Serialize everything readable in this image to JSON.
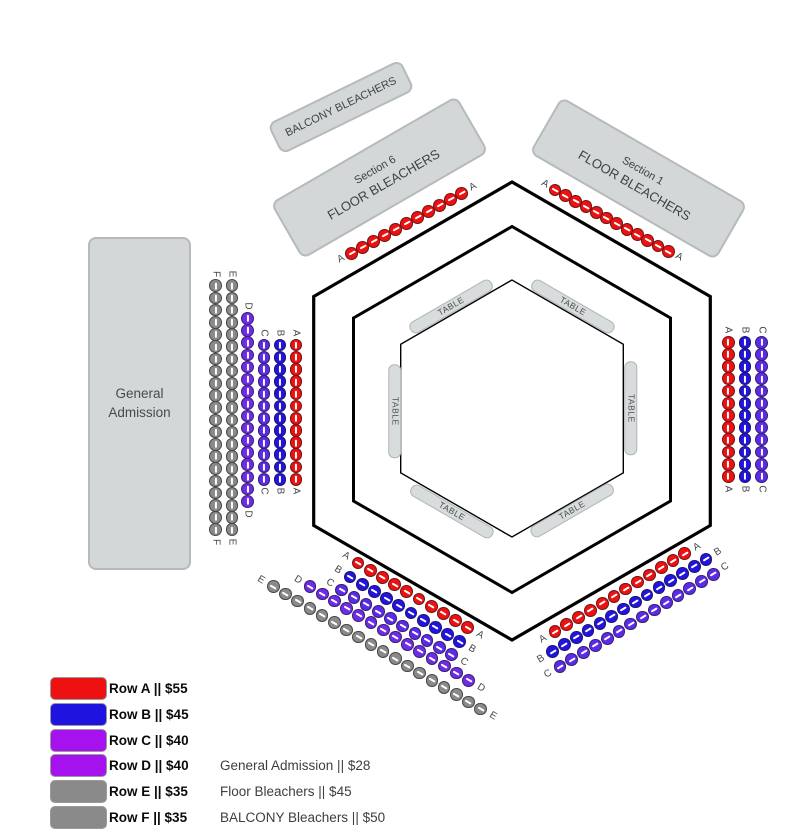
{
  "sections": {
    "balcony": {
      "label": "BALCONY BLEACHERS"
    },
    "section6": {
      "line1": "Section 6",
      "line2": "FLOOR BLEACHERS"
    },
    "section1": {
      "line1": "Section 1",
      "line2": "FLOOR BLEACHERS"
    },
    "general_admission": {
      "line1": "General",
      "line2": "Admission"
    }
  },
  "arena": {
    "stroke": "#000000",
    "hexagons": [
      {
        "cx": 512,
        "cy": 411,
        "r": 229,
        "sw": 3.2
      },
      {
        "cx": 512,
        "cy": 409.5,
        "r": 183,
        "sw": 3
      },
      {
        "cx": 512,
        "cy": 408.5,
        "r": 128.5,
        "sw": 1.4
      }
    ]
  },
  "tables": {
    "label": "TABLE",
    "items": [
      {
        "x": 451,
        "y": 306.5,
        "rot": -30
      },
      {
        "x": 573,
        "y": 306.5,
        "rot": 30
      },
      {
        "x": 394.5,
        "y": 411,
        "rot": 90
      },
      {
        "x": 631,
        "y": 408.5,
        "rot": 90
      },
      {
        "x": 451.5,
        "y": 511.5,
        "rot": 30
      },
      {
        "x": 571.5,
        "y": 510.5,
        "rot": -30
      }
    ]
  },
  "seat_colors": {
    "A": "#ee1111",
    "B": "#2213e0",
    "C": "#5c2be8",
    "D": "#6e2be8",
    "E": "#8a8a8a",
    "F": "#8a8a8a"
  },
  "seating": {
    "groups": [
      {
        "id": "top-left-A",
        "row": "A",
        "color": "A",
        "count": 11,
        "start": [
          351.7,
          253.3
        ],
        "step": [
          11,
          -6
        ]
      },
      {
        "id": "top-right-A",
        "row": "A",
        "color": "A",
        "count": 12,
        "start": [
          555,
          190
        ],
        "step": [
          10.3,
          5.6
        ]
      },
      {
        "id": "left-F",
        "row": "F",
        "color": "F",
        "count": 21,
        "start": [
          215.7,
          285.7
        ],
        "step": [
          0,
          12.2
        ]
      },
      {
        "id": "left-E",
        "row": "E",
        "color": "E",
        "count": 21,
        "start": [
          232,
          285.7
        ],
        "step": [
          0,
          12.2
        ]
      },
      {
        "id": "left-D",
        "row": "D",
        "color": "D",
        "count": 16,
        "start": [
          247.7,
          318.3
        ],
        "step": [
          0,
          12.2
        ]
      },
      {
        "id": "left-C",
        "row": "C",
        "color": "C",
        "count": 12,
        "start": [
          264,
          345
        ],
        "step": [
          0,
          12.2
        ]
      },
      {
        "id": "left-B",
        "row": "B",
        "color": "B",
        "count": 12,
        "start": [
          280,
          345
        ],
        "step": [
          0,
          12.2
        ]
      },
      {
        "id": "left-A",
        "row": "A",
        "color": "A",
        "count": 12,
        "start": [
          296,
          345
        ],
        "step": [
          0,
          12.2
        ]
      },
      {
        "id": "right-A",
        "row": "A",
        "color": "A",
        "count": 12,
        "start": [
          728.3,
          342.2
        ],
        "step": [
          0,
          12.2
        ]
      },
      {
        "id": "right-B",
        "row": "B",
        "color": "B",
        "count": 12,
        "start": [
          745,
          342.2
        ],
        "step": [
          0,
          12.2
        ]
      },
      {
        "id": "right-C",
        "row": "C",
        "color": "C",
        "count": 12,
        "start": [
          761.7,
          342.2
        ],
        "step": [
          0,
          12.2
        ]
      },
      {
        "id": "bottom-left-A",
        "row": "A",
        "color": "A",
        "count": 10,
        "start": [
          358,
          563
        ],
        "step": [
          12.2,
          7.2
        ]
      },
      {
        "id": "bottom-left-B",
        "row": "B",
        "color": "B",
        "count": 10,
        "start": [
          350,
          577
        ],
        "step": [
          12.2,
          7.2
        ]
      },
      {
        "id": "bottom-left-C",
        "row": "C",
        "color": "C",
        "count": 10,
        "start": [
          341.7,
          590
        ],
        "step": [
          12.2,
          7.2
        ]
      },
      {
        "id": "bottom-left-D",
        "row": "D",
        "color": "D",
        "count": 14,
        "start": [
          310,
          586.7
        ],
        "step": [
          12.2,
          7.2
        ]
      },
      {
        "id": "bottom-left-E",
        "row": "E",
        "color": "E",
        "count": 18,
        "start": [
          273.3,
          586.7
        ],
        "step": [
          12.2,
          7.2
        ]
      },
      {
        "id": "bottom-right-A",
        "row": "A",
        "color": "A",
        "count": 12,
        "start": [
          555,
          631.7
        ],
        "step": [
          11.8,
          -7.1
        ]
      },
      {
        "id": "bottom-right-B",
        "row": "B",
        "color": "B",
        "count": 14,
        "start": [
          552.7,
          651.7
        ],
        "step": [
          11.8,
          -7.1
        ]
      },
      {
        "id": "bottom-right-C",
        "row": "C",
        "color": "C",
        "count": 14,
        "start": [
          560,
          666.7
        ],
        "step": [
          11.8,
          -7.1
        ]
      }
    ]
  },
  "legend": {
    "geometry": {
      "x": 50,
      "y0": 677,
      "row_step": 25.8,
      "swatch_w": 57,
      "swatch_h": 23,
      "label_x": 109
    },
    "rows": [
      {
        "label": "Row A || $55",
        "color": "#ee1111"
      },
      {
        "label": "Row B || $45",
        "color": "#1f13e0"
      },
      {
        "label": "Row C || $40",
        "color": "#a512ee"
      },
      {
        "label": "Row D || $40",
        "color": "#a512ee"
      },
      {
        "label": "Row E || $35",
        "color": "#8a8a8a"
      },
      {
        "label": "Row F || $35",
        "color": "#8a8a8a"
      }
    ]
  },
  "notes": {
    "geometry": {
      "x": 220,
      "y0": 754.4,
      "row_step": 25.8
    },
    "items": [
      "General Admission || $28",
      "Floor Bleachers || $45",
      "BALCONY Bleachers || $50"
    ]
  }
}
